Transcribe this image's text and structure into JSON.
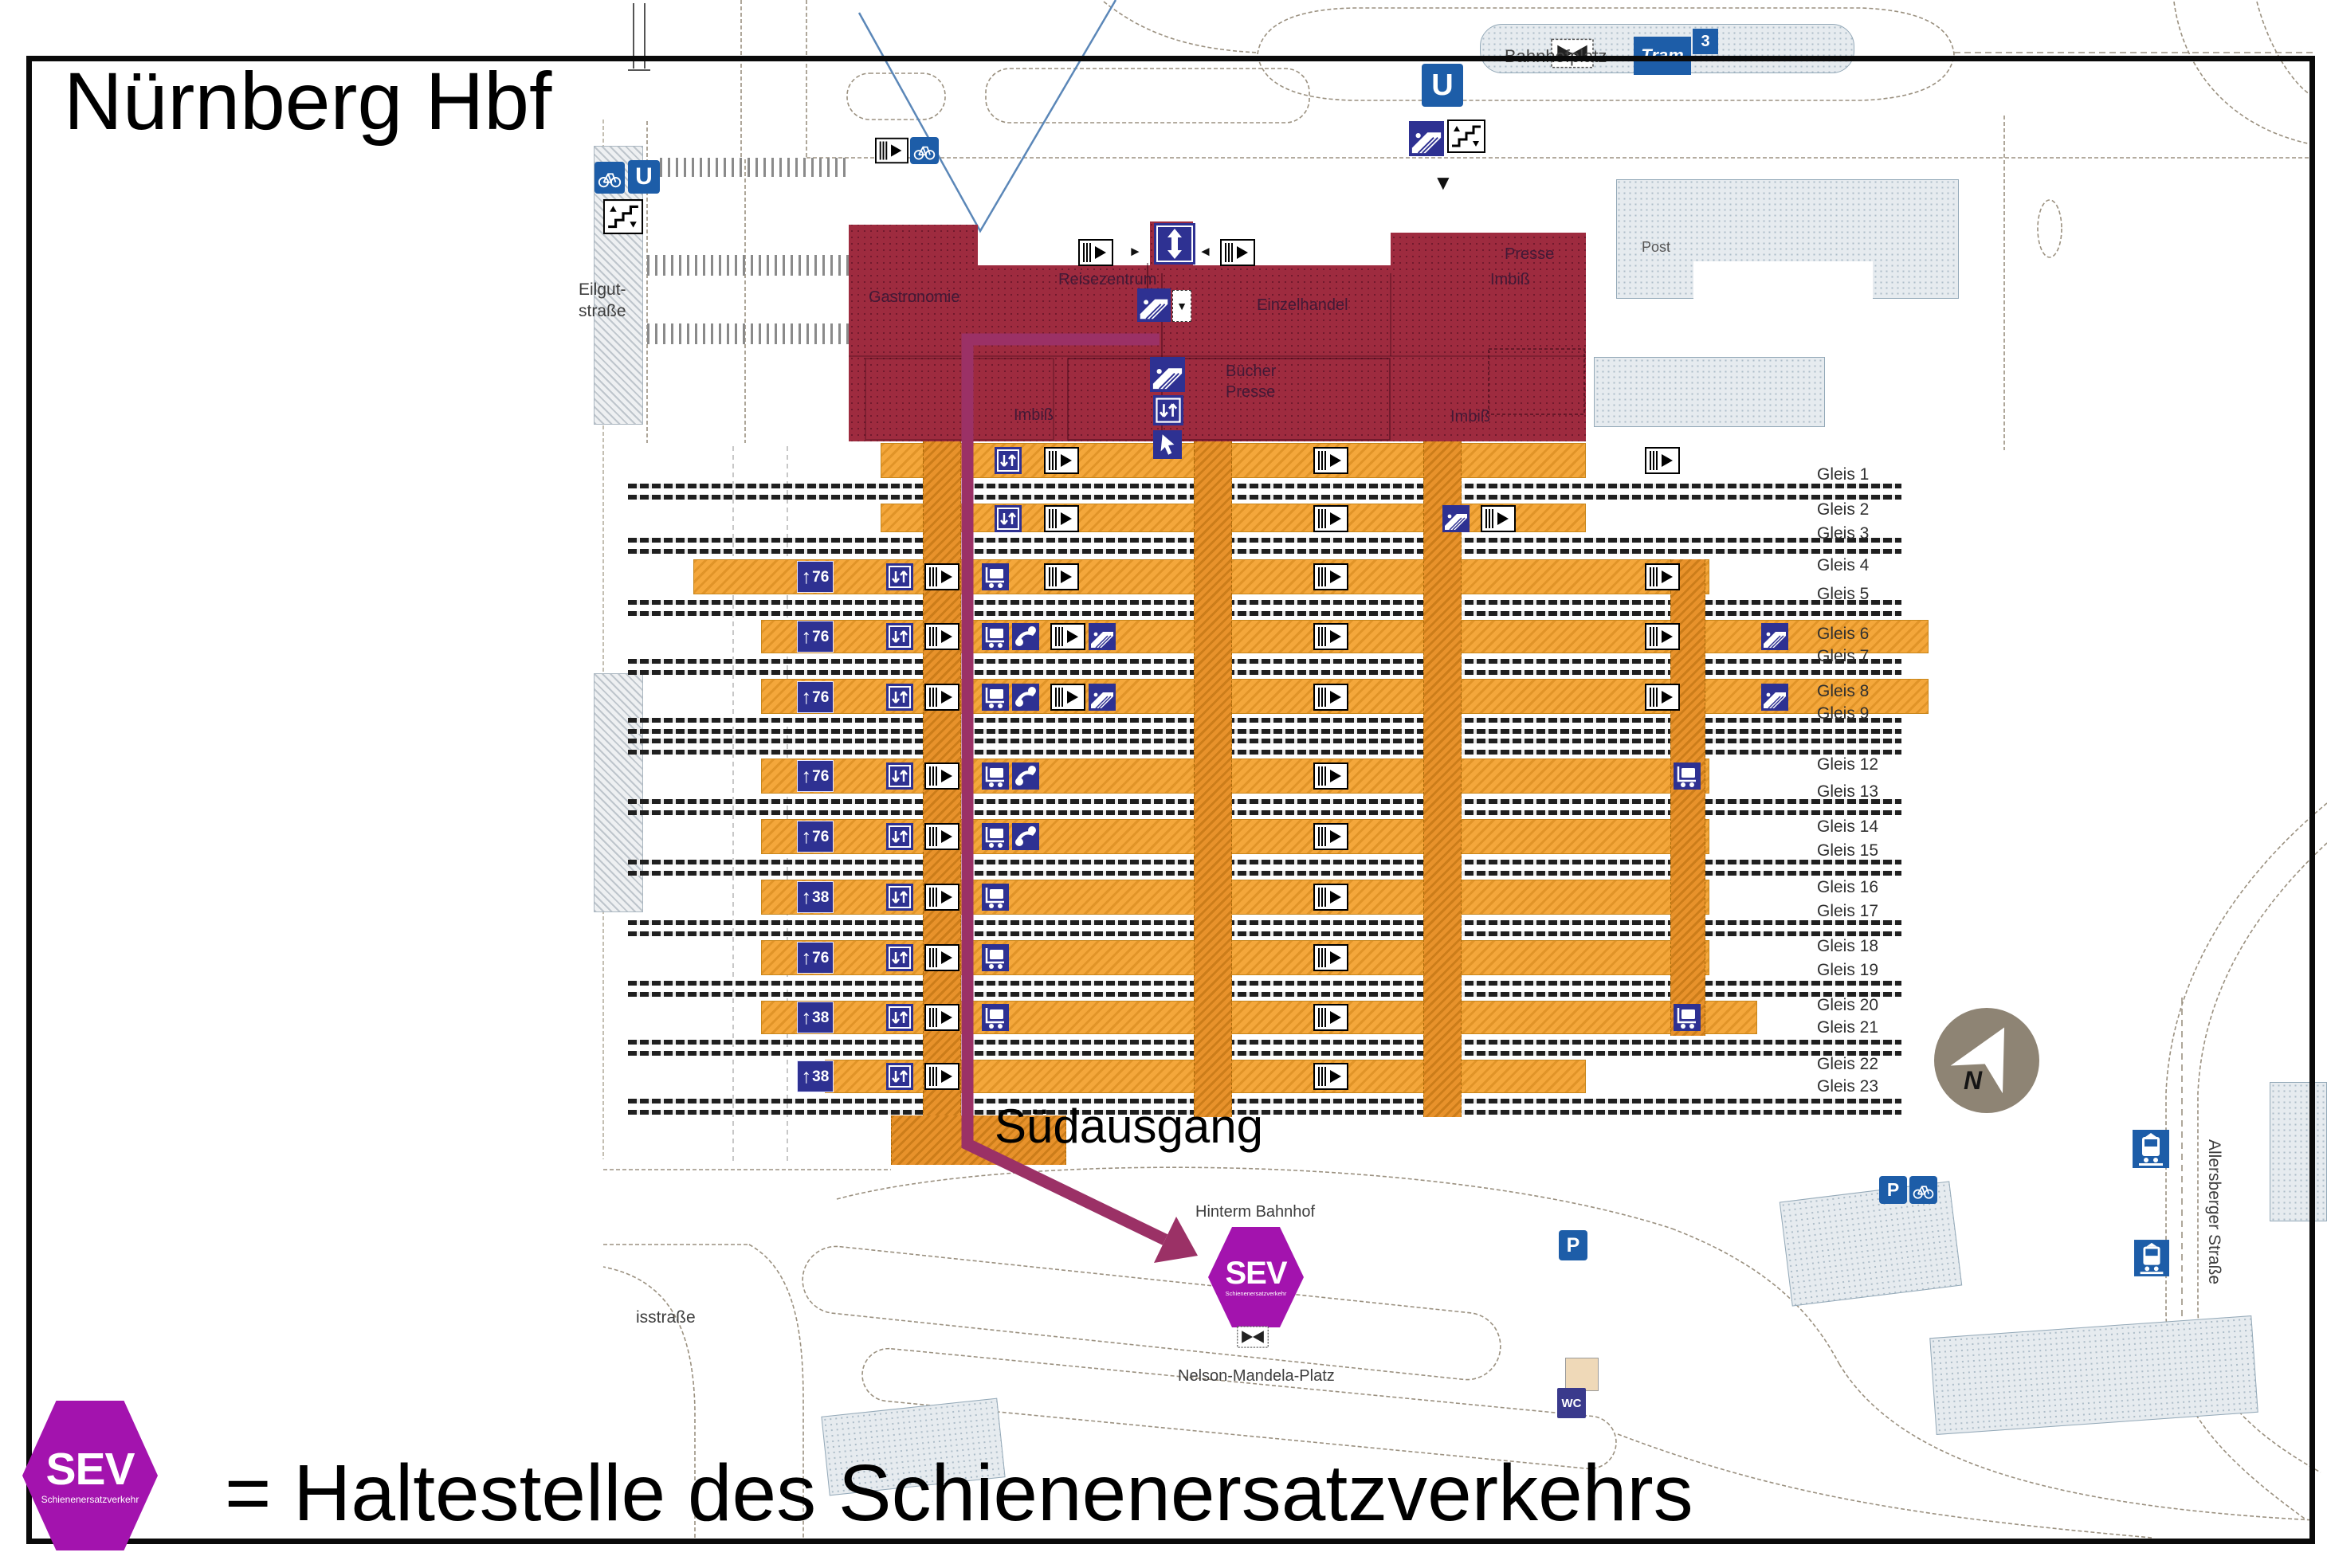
{
  "title": "Nürnberg Hbf",
  "legend": {
    "sev_label": "SEV",
    "sev_sublabel": "Schienenersatzverkehr",
    "text": "= Haltestelle des Schienenersatzverkehrs"
  },
  "map": {
    "south_exit_label": "Südausgang",
    "sev_stop": {
      "label": "SEV",
      "sublabel": "Schienenersatzverkehr"
    },
    "streets": {
      "bahnhofplatz": "Bahnhofplatz",
      "eilgutstrasse_line1": "Eilgut-",
      "eilgutstrasse_line2": "straße",
      "hinterm_bahnhof": "Hinterm Bahnhof",
      "nelson_mandela_platz": "Nelson-Mandela-Platz",
      "isstrasse": "isstraße",
      "allersberger_strasse": "Allersberger Straße"
    },
    "buildings": {
      "post": "Post",
      "station_rooms": [
        "Gastronomie",
        "Reisezentrum",
        "Einzelhandel",
        "Imbiß",
        "Presse",
        "Bücher",
        "Presse",
        "Imbiß",
        "Imbiß"
      ]
    },
    "transit_badges": {
      "tram": "Tram",
      "tram_line": "3",
      "ubahn": "U",
      "parking": "P",
      "wc": "WC"
    },
    "compass_n": "N",
    "platform_markers": {
      "arrow": "↑",
      "m76": "76",
      "m38": "38"
    },
    "gleis_labels": [
      "Gleis 1",
      "Gleis 2",
      "Gleis 3",
      "Gleis 4",
      "Gleis 5",
      "Gleis 6",
      "Gleis 7",
      "Gleis 8",
      "Gleis 9",
      "Gleis 12",
      "Gleis 13",
      "Gleis 14",
      "Gleis 15",
      "Gleis 16",
      "Gleis 17",
      "Gleis 18",
      "Gleis 19",
      "Gleis 20",
      "Gleis 21",
      "Gleis 22",
      "Gleis 23"
    ]
  },
  "icons": {
    "down_arrow": "▼",
    "left_arrow": "◄",
    "right_arrow": "►"
  },
  "colors": {
    "station_building": "#9E2B3F",
    "platform_orange": "#F4A73B",
    "route_purple": "#9B3166",
    "sev_purple": "#A313AE",
    "transport_blue": "#1D5DA8",
    "service_blue": "#2E3192"
  }
}
